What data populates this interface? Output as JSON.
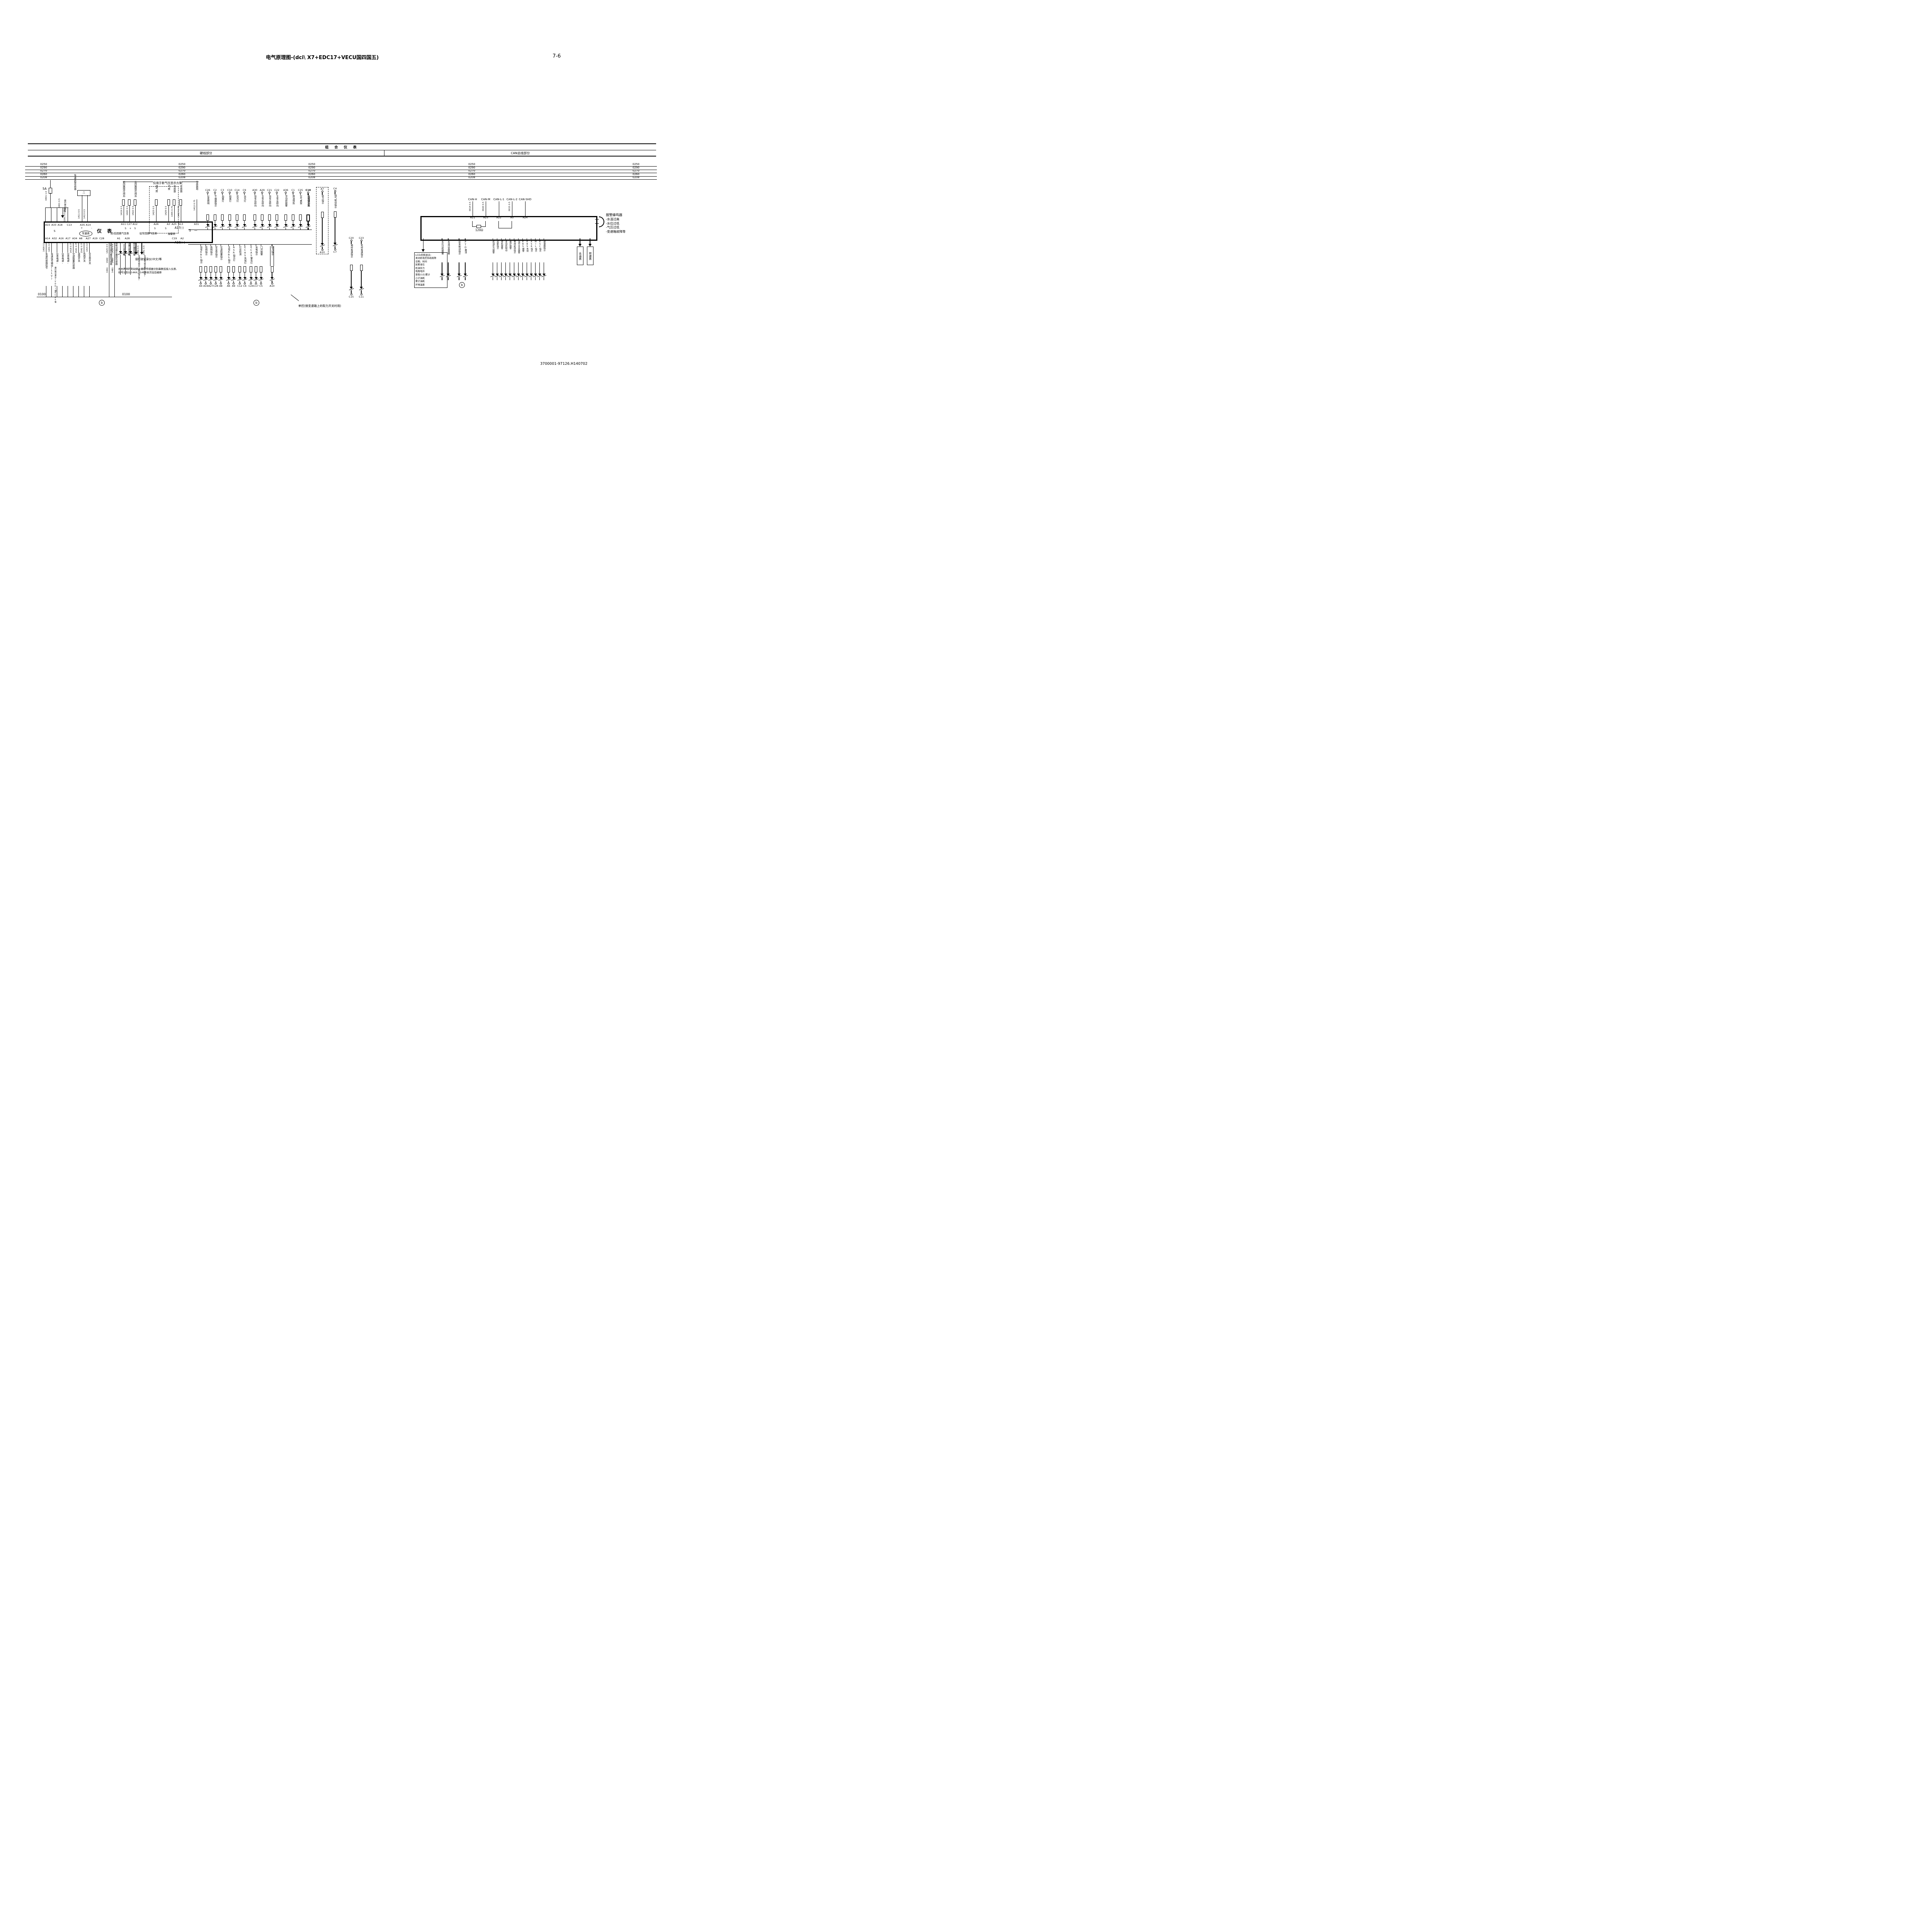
{
  "title": "电气原理图-(dci\\ X7+EDC17+VECU国四国五)",
  "page_number": "7-6",
  "doc_number": "3700001-97126.H140702",
  "header": {
    "group": "组 合 仪 表",
    "hardwired": "硬线部分",
    "canbus": "CAN总线部分"
  },
  "bus_wires": [
    "0250",
    "0290",
    "0270",
    "0260",
    "0208"
  ],
  "left": {
    "fuse": "5A",
    "fuse_wire": "0401 1.0",
    "recorder_wire": "0401 0.5",
    "recorder_label": "接行驶记录仪",
    "const_wire": "0291 0.5 常电",
    "speed_sensor": {
      "label": "车速里程传感器",
      "wire1": "1411 0.5",
      "wire2": "1413 0.5"
    },
    "new_air_note": "仅用于新气压显示方案",
    "top_static_pins": [
      "A15",
      "A33",
      "A18",
      "C13",
      "A35",
      "A14"
    ],
    "top_sensors_a": [
      {
        "wire": "1419 0.5",
        "label": "前回路限压阀后",
        "pin": "A11"
      },
      {
        "wire": "1420 0.5",
        "label": "",
        "pin": "C27"
      },
      {
        "wire": "1422 0.5",
        "label": "后回路限压阀后",
        "pin": "A12"
      }
    ],
    "top_sensors_b": [
      {
        "wire": "1423 0.5",
        "label": "驻挂储气筒",
        "pin": "A26"
      },
      {
        "wire": "1429 0.5",
        "label": "后储气筒",
        "pin": "A3"
      }
    ],
    "top_sensors_c": [
      {
        "wire": "1445 0.75",
        "label": "水位传感器",
        "pin": "A25"
      },
      {
        "wire": "1417 0.75",
        "label": "油量传感器",
        "pin": "A13"
      }
    ],
    "top_sensors_d": [
      {
        "wire": "1412 0.75",
        "label": "传感器地",
        "pin": "A31"
      }
    ],
    "box": {
      "s": "S",
      "title": "仪 表",
      "speedo": "车速表",
      "plus": "+",
      "minus": "-",
      "s_plus_s": "S + S",
      "s2": "S",
      "s3": "S",
      "gauge1": "前/后回路气压表",
      "gauge2": "驻车回路气压表",
      "gauge3": "油量表",
      "s_minus": "S —"
    },
    "bottom_pin_groups": {
      "g1": [
        "A14",
        "A32",
        "A16",
        "A17",
        "A34",
        "A8",
        "A27",
        "A19",
        "C28"
      ],
      "g2": [
        "A1",
        "A28"
      ],
      "g3": [
        "C19",
        "A2"
      ]
    },
    "bottom_columns": [
      {
        "wire": "1409 0.5",
        "label": "车速传感器信号"
      },
      {
        "wire": "1431 0.5",
        "label": "车速信号输出(11V)"
      },
      {
        "wire": "",
        "label": "仪表电源-"
      },
      {
        "wire": "",
        "label": "仪表电源-"
      },
      {
        "wire": "",
        "label": "仪表电源-"
      },
      {
        "wire": "1418 0.75",
        "label": "空滤阻塞传感器"
      },
      {
        "wire": "1541 0.75",
        "label": "高档开关"
      },
      {
        "wire": "1542 0.75",
        "label": "低档开关"
      },
      {
        "wire": "1415 0.5",
        "label": "安全带开关"
      }
    ],
    "vdo_note": "接行驶记录仪(VDO)接ECAS等",
    "brake_sensors": [
      {
        "wires": [
          "1425 0.5",
          "14A0",
          "14A1"
        ],
        "label": "左制动蹄片磨损传感器"
      },
      {
        "wires": [
          "1426 0.5",
          "14B0",
          "14B1"
        ],
        "label": "右制动蹄片磨损传感器"
      }
    ],
    "warn_leds": [
      "气压过低报警",
      "油量过低报警",
      "蹄片磨损报警"
    ],
    "speed_outputs": [
      {
        "wire": "14A0 0.5",
        "label": "车速信号输出(集电极开路)"
      },
      {
        "wire": "14A1 0.5",
        "label": "车速信号输出地(预留)"
      }
    ],
    "recorder_note": "接行驶记录仪(中文)等",
    "brake_note1": "左右两侧的制动蹄片磨损传感器分别串联后接入仪表,",
    "brake_note2": "线号分别以14AX、14BX依次往后编排",
    "ground": "0100",
    "circle_b": "b"
  },
  "middle": {
    "bus_neg": "A17(-)",
    "bus_pos": "A18(+)",
    "g1a": [
      {
        "pin": "C26",
        "label": "仪表照明"
      },
      {
        "pin": "C2",
        "label": "干燥器指示"
      },
      {
        "pin": "C3",
        "label": "后雾灯"
      },
      {
        "pin": "C10",
        "label": "前雾灯"
      },
      {
        "pin": "C14",
        "label": "近光灯"
      },
      {
        "pin": "C9",
        "label": "远光灯"
      }
    ],
    "g1b": [
      {
        "pin": "A30",
        "label": "挂车右转向"
      },
      {
        "pin": "A29",
        "label": "主车右转向"
      },
      {
        "pin": "C21",
        "label": "挂车左转向"
      },
      {
        "pin": "C22",
        "label": "主车左转向"
      }
    ],
    "g1c": [
      {
        "pin": "A36",
        "label": "浮动桥报警"
      },
      {
        "pin": "C1",
        "label": "燃油预热"
      },
      {
        "pin": "C25",
        "label": "空气悬架"
      }
    ],
    "mirror": {
      "pin": "C18",
      "label": "后视镜加热"
    },
    "g2a": [
      {
        "label": "挂车ABS指示",
        "pin": "A4"
      },
      {
        "label": "低档指示",
        "pin": "A19"
      },
      {
        "label": "高档指示",
        "pin": "A27"
      },
      {
        "label": "安全带指示",
        "pin": "C28"
      },
      {
        "label": "空滤阻塞指示",
        "pin": "A8"
      }
    ],
    "g2b": [
      {
        "label": "主车ABS指示",
        "pin": "A6"
      },
      {
        "label": "ASR指示灯",
        "pin": "A9"
      }
    ],
    "g2c": [
      {
        "label": "灯丝检测",
        "pin": "C12"
      },
      {
        "label": "ECAS失效灯",
        "pin": "C6"
      }
    ],
    "g2d": [
      {
        "label": "ECAS警告灯",
        "pin": "C24"
      },
      {
        "label": "充电指示",
        "pin": "C17"
      },
      {
        "label": "门开报警",
        "pin": "C5"
      }
    ],
    "pto": {
      "label": "取力指示",
      "pin": "A10"
    },
    "pto_box": {
      "pin_top": "A7",
      "label": "取力指示",
      "pin_bottom": "A10"
    },
    "exhaust": {
      "pin_top": "C4",
      "label": "排气制动指示",
      "pin_bottom": "C7"
    },
    "diff": [
      {
        "pin_top": "C20",
        "label": "轴间差速指示",
        "pin_bottom": "C15"
      },
      {
        "pin_top": "C23",
        "label": "轮间差速指示",
        "pin_bottom": "C11"
      }
    ],
    "note": "单控(接变速箱上的取力开关时用)",
    "circle_b": "b"
  },
  "right": {
    "can": [
      {
        "label": "CAN-H",
        "wire": "0014 0.5",
        "pin": "A21"
      },
      {
        "label": "CAN-M",
        "wire": "0020 0.5",
        "pin": "A23"
      },
      {
        "label": "CAN-L-1",
        "wire": "",
        "pin": "A22"
      },
      {
        "label": "CAN-L-2",
        "wire": "0015 0.5",
        "pin": "A5"
      },
      {
        "label": "CAN-SHD",
        "wire": "",
        "pin": "A24"
      }
    ],
    "resistor": "120Ω",
    "buzzer_title": "报警蜂鸣器",
    "buzzer_items": [
      "-水温过高",
      "-水位过低",
      "-气压过低",
      "-变速箱故障等"
    ],
    "lcd_title": "LCD点阵显示:",
    "lcd_items": [
      "发动机电控系统故障",
      "日期、时间",
      "尿素液位",
      "机油压力",
      "电瓶电压",
      "里程小计/累计",
      "小计油耗",
      "累计油耗",
      "环境温度"
    ],
    "ind_a": [
      "水位过低报警",
      "水温过高报警"
    ],
    "ind_b": [
      "驻车制动指示",
      "PTO激活"
    ],
    "ind_c": [
      "机油压力报警",
      "巡航指示",
      "停机报警",
      "发动机制动",
      "维护报警",
      "等待起动指示",
      "油中含水报警",
      "EBS报警",
      "EBS失效",
      "ASR指示",
      "MIL指示",
      "ESC指示",
      "缓速器指示"
    ],
    "gauges": [
      "水温表",
      "转速表"
    ],
    "circle_b": "b"
  }
}
